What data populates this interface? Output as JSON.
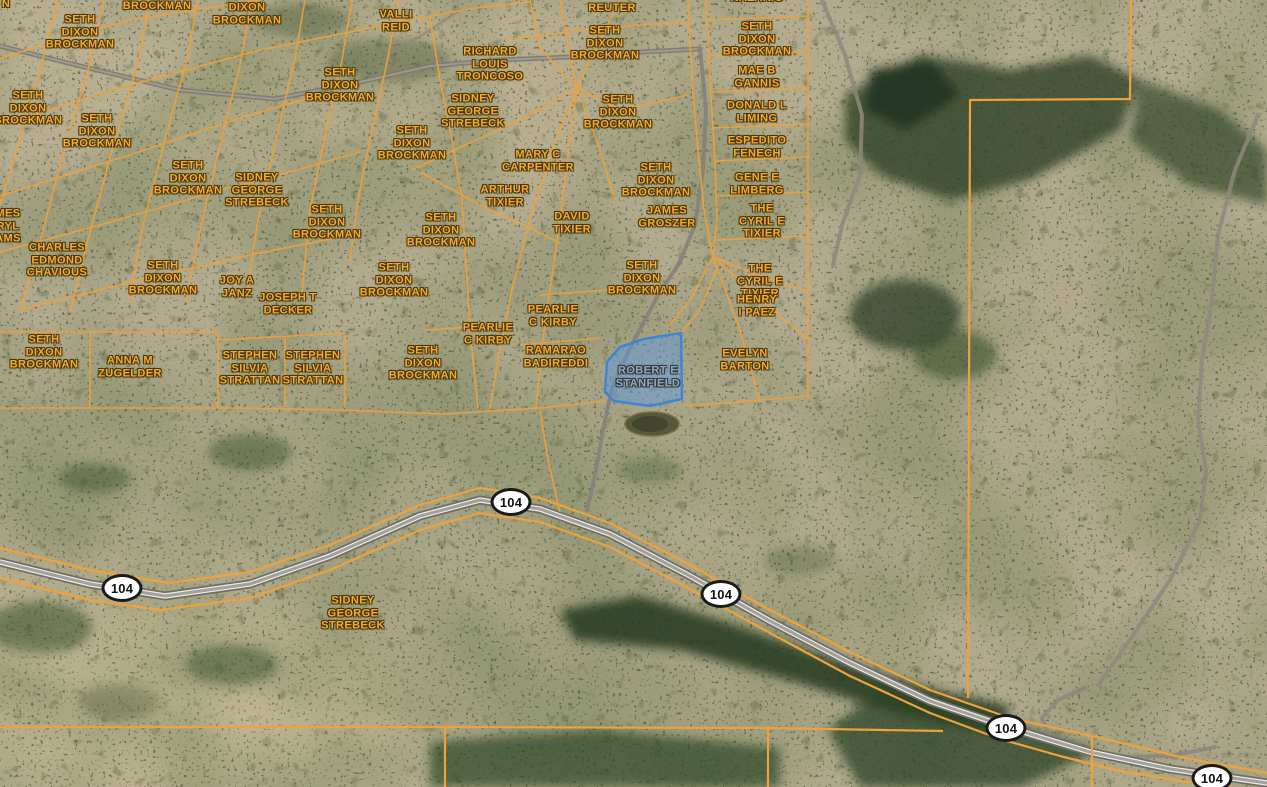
{
  "map": {
    "highway": {
      "route_number": "104"
    },
    "selected_parcel": {
      "owner": "ROBERT E STANFIELD"
    },
    "colors": {
      "parcel_line": "#eda23b",
      "owner_label_text": "#f3ab35",
      "owner_label_outline": "#4a3608",
      "selected_parcel_fill": "rgba(86,152,232,0.45)",
      "selected_parcel_stroke": "#3f85d6",
      "selected_label_text": "#9aa8b4",
      "shield_background": "#ffffff",
      "shield_border": "#1a1a1a",
      "terrain_base": "#b2aa8e"
    },
    "route_shields": [
      {
        "label": "104",
        "x": 511,
        "y": 502
      },
      {
        "label": "104",
        "x": 122,
        "y": 588
      },
      {
        "label": "104",
        "x": 721,
        "y": 594
      },
      {
        "label": "104",
        "x": 1006,
        "y": 728
      },
      {
        "label": "104",
        "x": 1212,
        "y": 778
      }
    ],
    "labels": [
      {
        "style": "fragment",
        "lines": [
          "N"
        ],
        "x": 6,
        "y": 4
      },
      {
        "style": "owner",
        "lines": [
          "BROCKMAN"
        ],
        "x": 157,
        "y": 6
      },
      {
        "style": "owner",
        "lines": [
          "DIXON",
          "BROCKMAN"
        ],
        "x": 247,
        "y": 14
      },
      {
        "style": "owner",
        "lines": [
          "SETH",
          "DIXON",
          "BROCKMAN"
        ],
        "x": 80,
        "y": 32
      },
      {
        "style": "owner",
        "lines": [
          "VALLI",
          "REID"
        ],
        "x": 396,
        "y": 21
      },
      {
        "style": "owner",
        "lines": [
          "REUTER"
        ],
        "x": 612,
        "y": 8
      },
      {
        "style": "owner",
        "lines": [
          "NAZARIO"
        ],
        "x": 757,
        "y": -2
      },
      {
        "style": "owner",
        "lines": [
          "SETH",
          "DIXON",
          "BROCKMAN"
        ],
        "x": 605,
        "y": 43
      },
      {
        "style": "owner",
        "lines": [
          "SETH",
          "DIXON",
          "BROCKMAN"
        ],
        "x": 757,
        "y": 39
      },
      {
        "style": "owner",
        "lines": [
          "RICHARD",
          "LOUIS",
          "TRONCOSO"
        ],
        "x": 490,
        "y": 64
      },
      {
        "style": "owner",
        "lines": [
          "MAE B",
          "GANNIS"
        ],
        "x": 757,
        "y": 77
      },
      {
        "style": "owner",
        "lines": [
          "SETH",
          "DIXON",
          "BROCKMAN"
        ],
        "x": 28,
        "y": 108
      },
      {
        "style": "owner",
        "lines": [
          "SETH",
          "DIXON",
          "BROCKMAN"
        ],
        "x": 340,
        "y": 85
      },
      {
        "style": "owner",
        "lines": [
          "SIDNEY",
          "GEORGE",
          "STREBECK"
        ],
        "x": 473,
        "y": 111
      },
      {
        "style": "owner",
        "lines": [
          "SETH",
          "DIXON",
          "BROCKMAN"
        ],
        "x": 618,
        "y": 112
      },
      {
        "style": "owner",
        "lines": [
          "DONALD L",
          "LIMING"
        ],
        "x": 757,
        "y": 112
      },
      {
        "style": "owner",
        "lines": [
          "SETH",
          "DIXON",
          "BROCKMAN"
        ],
        "x": 97,
        "y": 131
      },
      {
        "style": "owner",
        "lines": [
          "SETH",
          "DIXON",
          "BROCKMAN"
        ],
        "x": 412,
        "y": 143
      },
      {
        "style": "owner",
        "lines": [
          "ESPEDITO",
          "FENECH"
        ],
        "x": 757,
        "y": 147
      },
      {
        "style": "owner",
        "lines": [
          "MARY C",
          "CARPENTER"
        ],
        "x": 538,
        "y": 161
      },
      {
        "style": "owner",
        "lines": [
          "SETH",
          "DIXON",
          "BROCKMAN"
        ],
        "x": 188,
        "y": 178
      },
      {
        "style": "owner",
        "lines": [
          "SIDNEY",
          "GEORGE",
          "STREBECK"
        ],
        "x": 257,
        "y": 190
      },
      {
        "style": "owner",
        "lines": [
          "GENE E",
          "LIMBERG"
        ],
        "x": 757,
        "y": 184
      },
      {
        "style": "owner",
        "lines": [
          "SETH",
          "DIXON",
          "BROCKMAN"
        ],
        "x": 656,
        "y": 180
      },
      {
        "style": "owner",
        "lines": [
          "ARTHUR",
          "TIXIER"
        ],
        "x": 505,
        "y": 196
      },
      {
        "style": "owner",
        "lines": [
          "THE",
          "CYRIL E",
          "TIXIER"
        ],
        "x": 762,
        "y": 221
      },
      {
        "style": "owner",
        "lines": [
          "DAVID",
          "TIXIER"
        ],
        "x": 572,
        "y": 223
      },
      {
        "style": "owner",
        "lines": [
          "JAMES",
          "GROSZER"
        ],
        "x": 667,
        "y": 217
      },
      {
        "style": "owner",
        "lines": [
          "SETH",
          "DIXON",
          "BROCKMAN"
        ],
        "x": 327,
        "y": 222
      },
      {
        "style": "owner",
        "lines": [
          "SETH",
          "DIXON",
          "BROCKMAN"
        ],
        "x": 441,
        "y": 230
      },
      {
        "style": "fragment",
        "lines": [
          "MES",
          "RYL",
          "AMS"
        ],
        "x": 8,
        "y": 226
      },
      {
        "style": "owner",
        "lines": [
          "CHARLES",
          "EDMOND",
          "CHAVIOUS"
        ],
        "x": 57,
        "y": 260
      },
      {
        "style": "owner",
        "lines": [
          "SETH",
          "DIXON",
          "BROCKMAN"
        ],
        "x": 163,
        "y": 278
      },
      {
        "style": "owner",
        "lines": [
          "JOY A",
          "JANZ"
        ],
        "x": 237,
        "y": 287
      },
      {
        "style": "owner",
        "lines": [
          "SETH",
          "DIXON",
          "BROCKMAN"
        ],
        "x": 394,
        "y": 280
      },
      {
        "style": "owner",
        "lines": [
          "SETH",
          "DIXON",
          "BROCKMAN"
        ],
        "x": 642,
        "y": 278
      },
      {
        "style": "owner",
        "lines": [
          "THE",
          "CYRIL E",
          "TIXIER"
        ],
        "x": 760,
        "y": 281
      },
      {
        "style": "owner",
        "lines": [
          "JOSEPH T",
          "DECKER"
        ],
        "x": 288,
        "y": 304
      },
      {
        "style": "owner",
        "lines": [
          "HENRY",
          "I PAEZ"
        ],
        "x": 757,
        "y": 306
      },
      {
        "style": "owner",
        "lines": [
          "PEARLIE",
          "C KIRBY"
        ],
        "x": 553,
        "y": 316
      },
      {
        "style": "owner",
        "lines": [
          "PEARLIE",
          "C KIRBY"
        ],
        "x": 488,
        "y": 334
      },
      {
        "style": "owner",
        "lines": [
          "SETH",
          "DIXON",
          "BROCKMAN"
        ],
        "x": 44,
        "y": 352
      },
      {
        "style": "owner",
        "lines": [
          "RAMARAO",
          "BADIREDDI"
        ],
        "x": 556,
        "y": 357
      },
      {
        "style": "owner",
        "lines": [
          "ANNA M",
          "ZUGELDER"
        ],
        "x": 130,
        "y": 367
      },
      {
        "style": "owner",
        "lines": [
          "STEPHEN",
          "SILVIA",
          "STRATTAN"
        ],
        "x": 250,
        "y": 368
      },
      {
        "style": "owner",
        "lines": [
          "STEPHEN",
          "SILVIA",
          "STRATTAN"
        ],
        "x": 313,
        "y": 368
      },
      {
        "style": "owner",
        "lines": [
          "SETH",
          "DIXON",
          "BROCKMAN"
        ],
        "x": 423,
        "y": 363
      },
      {
        "style": "owner",
        "lines": [
          "EVELYN",
          "BARTON"
        ],
        "x": 745,
        "y": 360
      },
      {
        "style": "selected",
        "lines": [
          "ROBERT E",
          "STANFIELD"
        ],
        "x": 648,
        "y": 377
      },
      {
        "style": "owner",
        "lines": [
          "SIDNEY",
          "GEORGE",
          "STREBECK"
        ],
        "x": 353,
        "y": 613
      }
    ]
  }
}
